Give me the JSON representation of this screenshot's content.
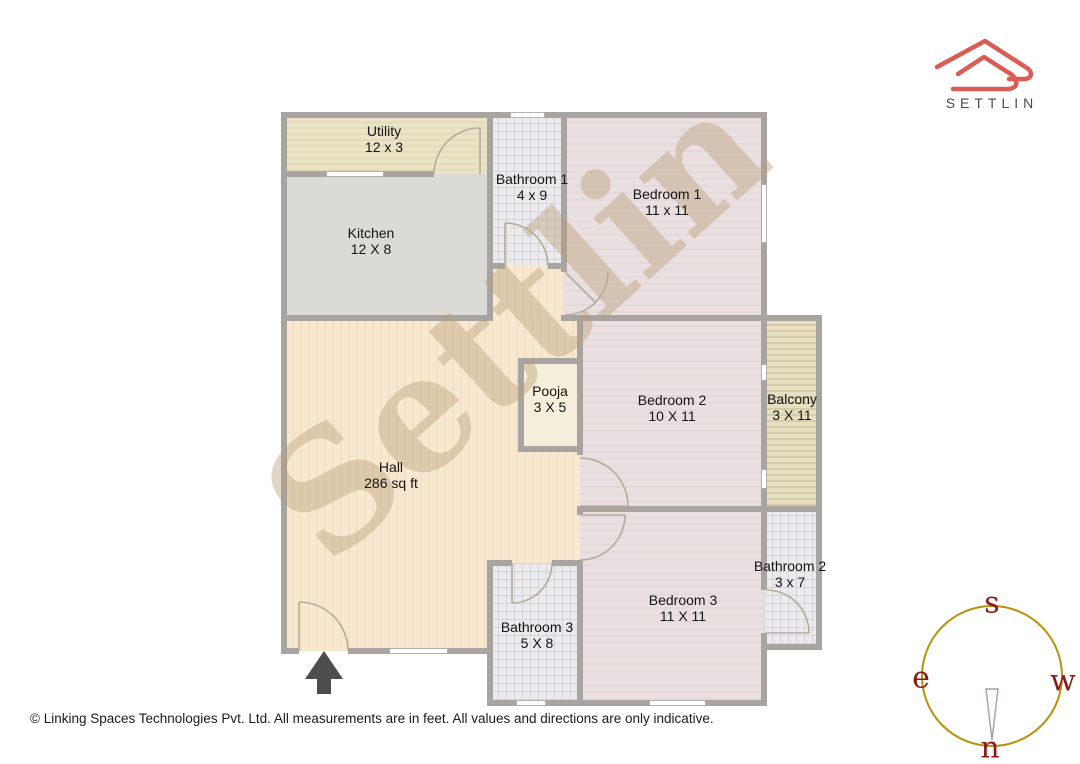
{
  "logo": {
    "brand": "SETTLIN",
    "accent_color": "#d95c55",
    "text_color": "#4a4a4a"
  },
  "watermark": {
    "text": "Settlin",
    "color": "rgba(184,158,120,0.42)"
  },
  "rooms": [
    {
      "name": "Utility",
      "dims": "12 x 3",
      "fill": "#ebe3c6"
    },
    {
      "name": "Kitchen",
      "dims": "12 X 8",
      "fill": "#dbdad7"
    },
    {
      "name": "Bathroom 1",
      "dims": "4 x 9",
      "fill": "#ebeaed"
    },
    {
      "name": "Bedroom 1",
      "dims": "11 x 11",
      "fill": "#eae0e1"
    },
    {
      "name": "Pooja",
      "dims": "3 X 5",
      "fill": "#f4eeda"
    },
    {
      "name": "Bedroom 2",
      "dims": "10 X 11",
      "fill": "#eae0e1"
    },
    {
      "name": "Balcony",
      "dims": "3 X 11",
      "fill": "#e6dfc0"
    },
    {
      "name": "Hall",
      "dims": "286 sq ft",
      "fill": "#f8e8d0"
    },
    {
      "name": "Bathroom 3",
      "dims": "5 X 8",
      "fill": "#ebeaed"
    },
    {
      "name": "Bedroom 3",
      "dims": "11 X 11",
      "fill": "#eae0e1"
    },
    {
      "name": "Bathroom 2",
      "dims": "3 x 7",
      "fill": "#ebeaed"
    }
  ],
  "plan": {
    "wall_color": "#a7a4a1",
    "door_arc_color": "#b6ab9b",
    "entrance_arrow_color": "#4d4d4d",
    "window_color": "#ffffff"
  },
  "compass": {
    "top": "s",
    "left": "e",
    "right": "w",
    "bottom": "n",
    "circle_color": "#b5930b",
    "letter_color": "#8b1a12"
  },
  "footer": {
    "copyright": "© Linking Spaces Technologies Pvt. Ltd. All measurements are in feet. All values and directions are only indicative."
  }
}
